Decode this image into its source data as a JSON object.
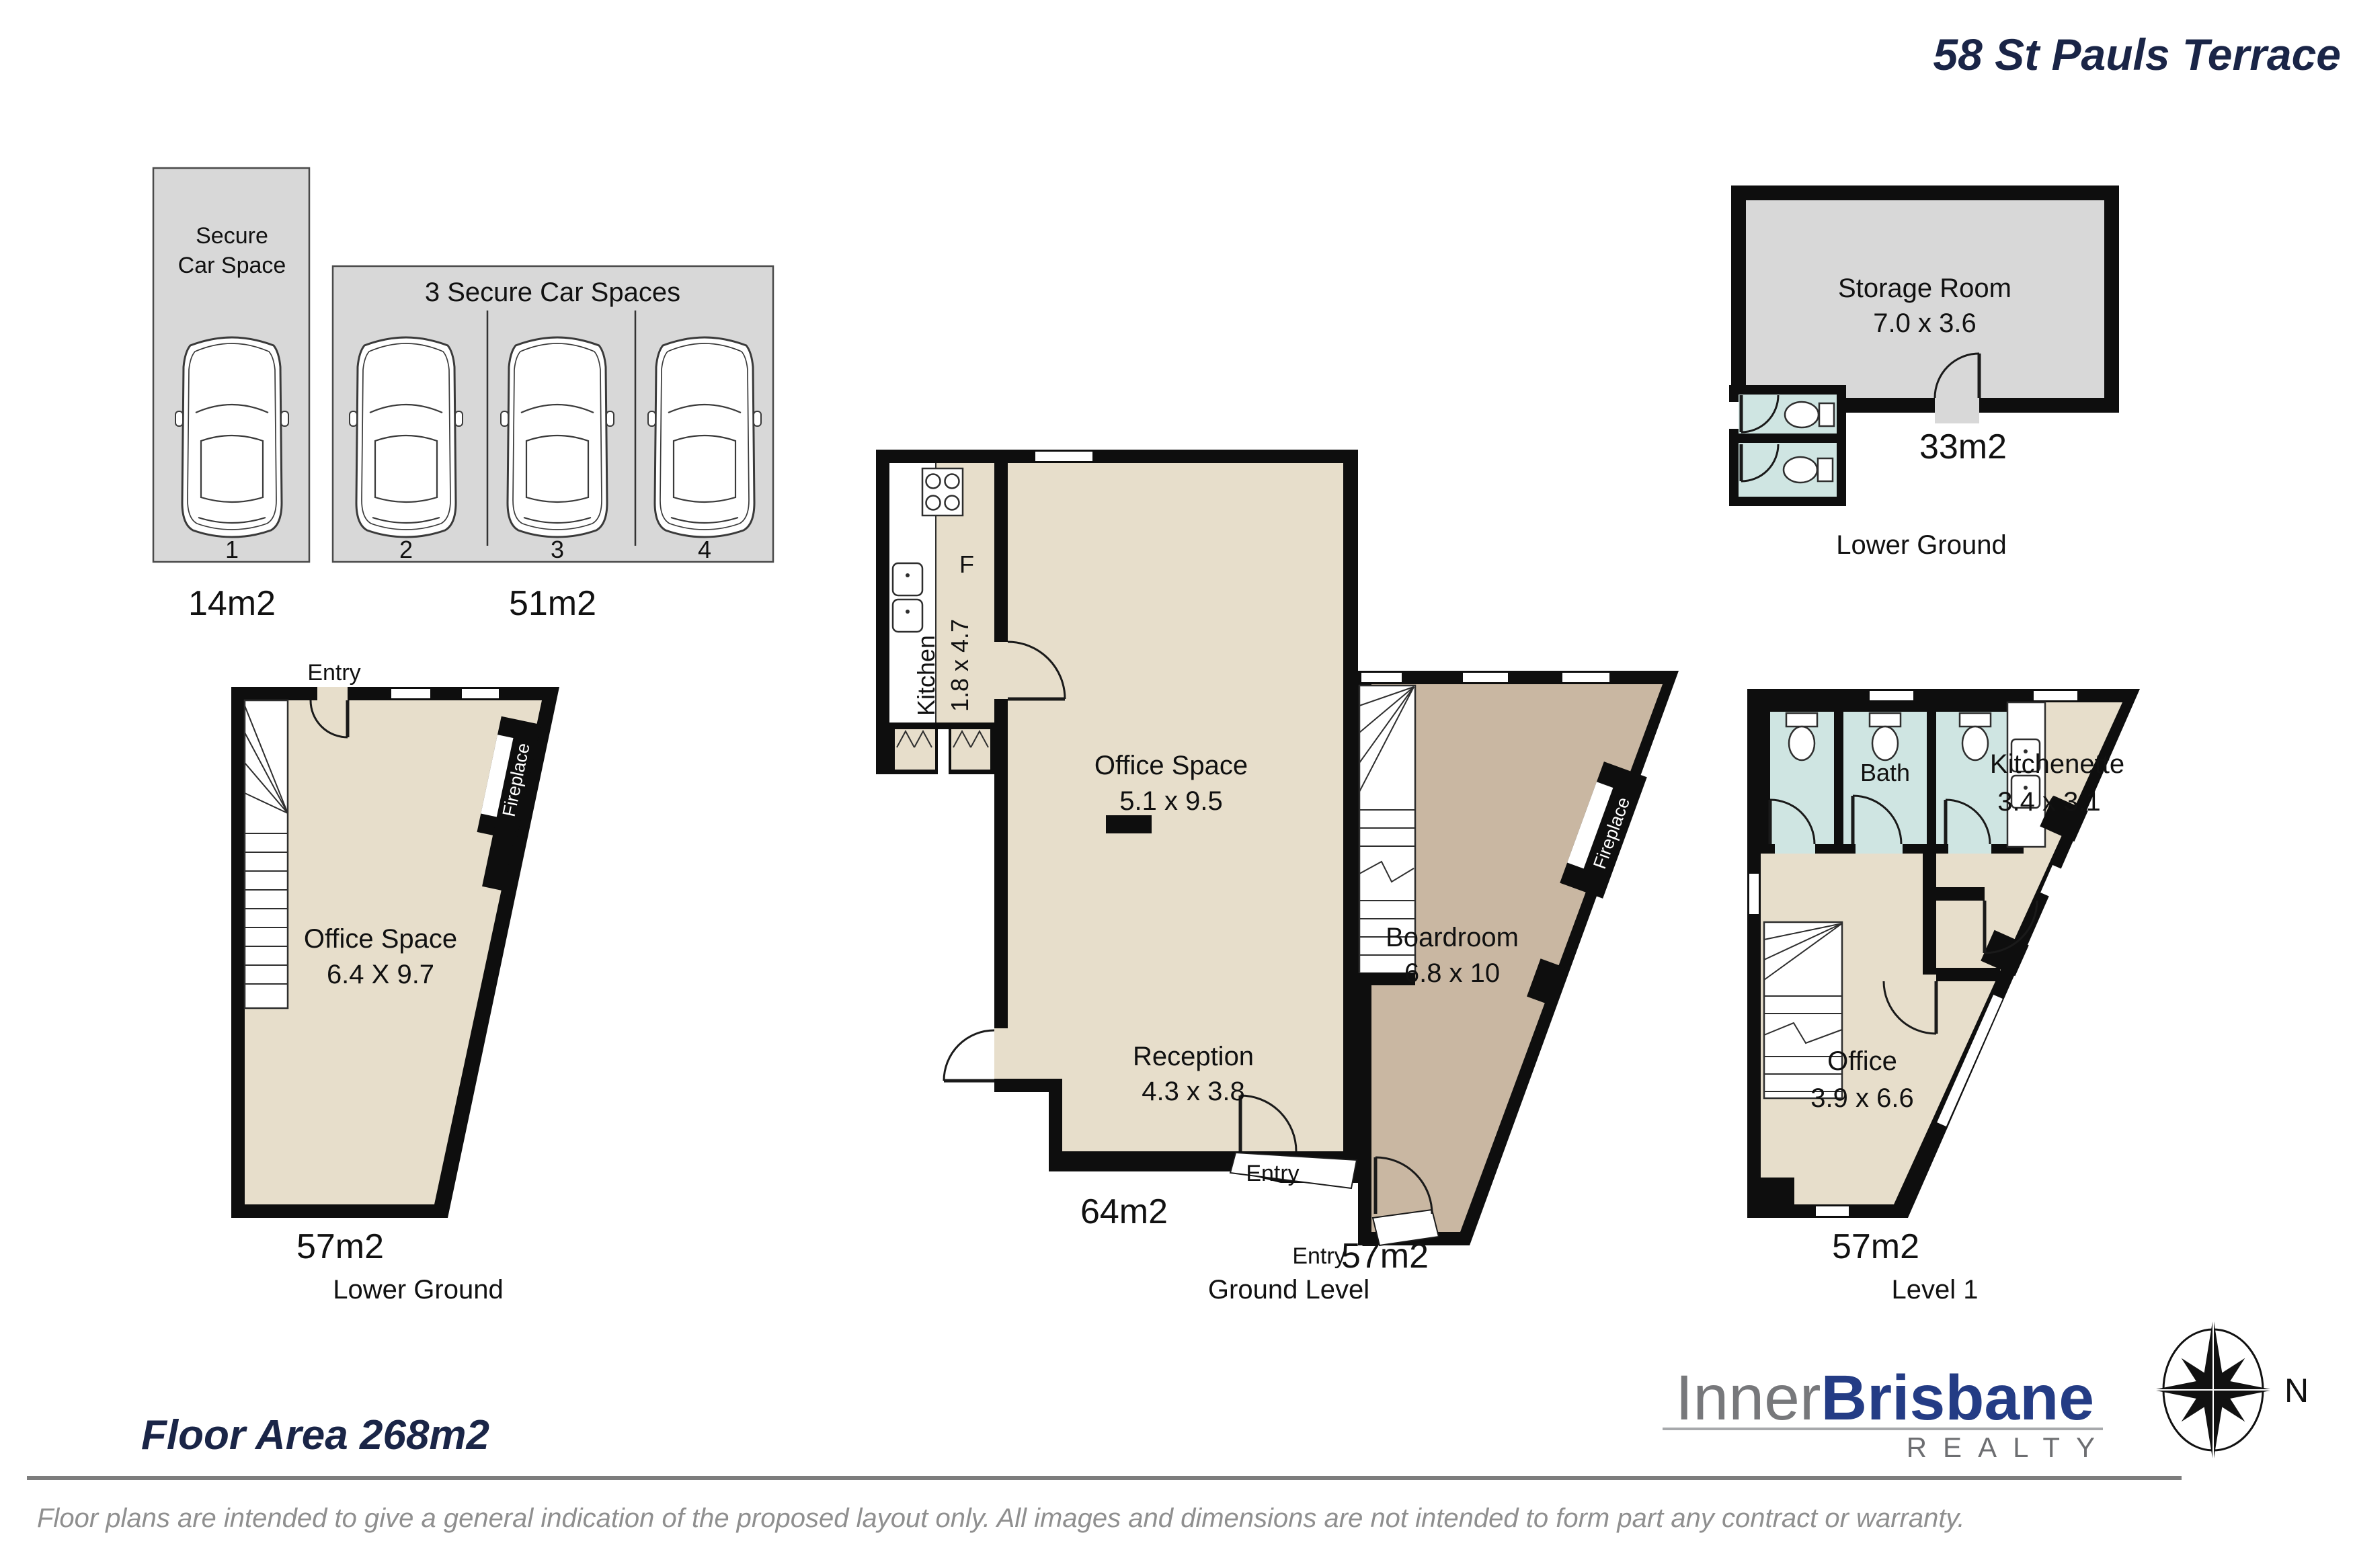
{
  "title": "58 St Pauls Terrace",
  "palette": {
    "navy": "#1a2547",
    "wall_black": "#0e0e0e",
    "office_beige": "#e7decb",
    "boardroom_taupe": "#c9b7a2",
    "parking_gray": "#d8d8d8",
    "bath_teal": "#cfe5e2",
    "logo_gray": "#77787b",
    "logo_blue": "#243c85",
    "muted_gray": "#8f8f8f"
  },
  "parking": {
    "single": {
      "title_line1": "Secure",
      "title_line2": "Car Space",
      "space_number": "1",
      "area": "14m2"
    },
    "triple": {
      "title": "3 Secure Car Spaces",
      "space_numbers": [
        "2",
        "3",
        "4"
      ],
      "area": "51m2"
    }
  },
  "storage_plan": {
    "room": "Storage Room",
    "dims": "7.0 x 3.6",
    "area": "33m2",
    "level": "Lower Ground"
  },
  "lower_ground_plan": {
    "entry": "Entry",
    "fireplace": "Fireplace",
    "room": "Office Space",
    "dims": "6.4 X 9.7",
    "area": "57m2",
    "level": "Lower Ground"
  },
  "ground_plan": {
    "kitchen": "Kitchen",
    "kitchen_dims": "1.8 x 4.7",
    "fridge": "F",
    "office": "Office Space",
    "office_dims": "5.1 x 9.5",
    "reception": "Reception",
    "reception_dims": "4.3 x 3.8",
    "entry_left": "Entry",
    "area_left": "64m2",
    "boardroom": "Boardroom",
    "boardroom_dims": "6.8 x 10",
    "fireplace": "Fireplace",
    "entry_right": "Entry",
    "area_right": "57m2",
    "level": "Ground Level"
  },
  "level1_plan": {
    "bath": "Bath",
    "kitchenette": "Kitchenette",
    "kitchenette_dims": "3.4 x 3.1",
    "office": "Office",
    "office_dims": "3.9 x 6.6",
    "area": "57m2",
    "level": "Level 1"
  },
  "summary": {
    "floor_area": "Floor Area 268m2"
  },
  "branding": {
    "logo_part1": "Inner",
    "logo_part2": "Brisbane",
    "logo_part3": "REALTY",
    "compass_north": "N"
  },
  "disclaimer": "Floor plans are intended to give a general indication of the proposed layout only. All images and dimensions are not intended to form part any contract or warranty."
}
